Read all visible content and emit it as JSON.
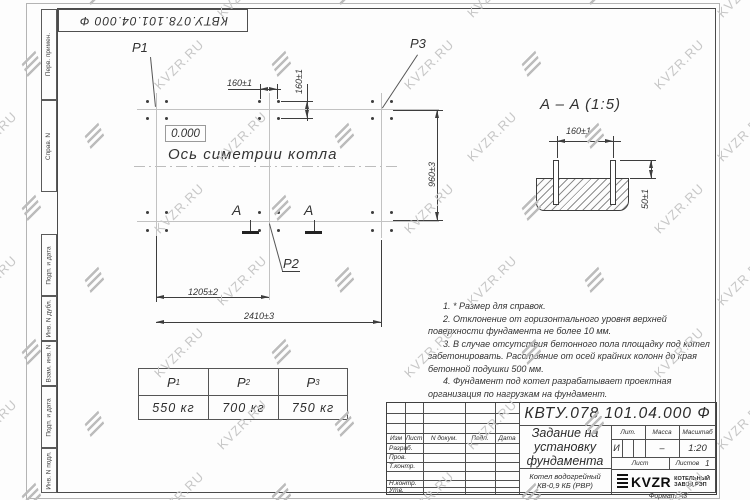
{
  "watermark": {
    "text": "KVZR.RU"
  },
  "corner_stamp": {
    "designation": "КВТУ.078.101.04.000 Ф"
  },
  "margin_columns": {
    "labels": [
      "Перв. примен.",
      "Справ. N",
      "Подп. и дата",
      "Инв. N дубл.",
      "Взам. инв. N",
      "Подп. и дата",
      "Инв. N подл."
    ]
  },
  "plan_view": {
    "load_labels": {
      "p1": "P1",
      "p2": "P2",
      "p3": "P3"
    },
    "elevation_mark": "0.000",
    "symmetry_axis_label": "Ось симетрии котла",
    "section_letter_left": "A",
    "section_letter_right": "A",
    "dimensions": {
      "bolt_spacing_horizontal": "160±1",
      "bolt_spacing_vertical": "160±1",
      "foundation_width": "960±3",
      "axis_to_center": "1205±2",
      "overall_length": "2410±3"
    }
  },
  "section_view": {
    "title": "A – A (1:5)",
    "dimensions": {
      "bolt_spacing": "160±1",
      "bolt_protrusion": "50±1"
    }
  },
  "notes": [
    "1. * Размер для справок.",
    "2. Отклонение от горизонтального уровня верхней поверхности фундамента не более 10 мм.",
    "3. В случае отсутствия бетонного пола площадку под котел забетонировать. Расстояние от осей крайних колонн до края бетонной подушки 500 мм.",
    "4. Фундамент под котел разрабатывает проектная организация по нагрузкам на фундамент."
  ],
  "load_table": {
    "headers": [
      {
        "symbol": "P",
        "index": "1"
      },
      {
        "symbol": "P",
        "index": "2"
      },
      {
        "symbol": "P",
        "index": "3"
      }
    ],
    "values": [
      "550 кг",
      "700 кг",
      "750 кг"
    ]
  },
  "title_block": {
    "designation": "КВТУ.078.101.04.000 Ф",
    "title_lines": [
      "Задание на",
      "установку",
      "фундамента"
    ],
    "product_lines": [
      "Котел водогрейный",
      "КВ-0,9 КБ (РВР)"
    ],
    "revision_headers": [
      "Изм",
      "Лист",
      "N докум.",
      "Подп.",
      "Дата"
    ],
    "signature_labels": [
      "Разраб.",
      "Пров.",
      "Т.контр.",
      "Н.контр.",
      "Утв."
    ],
    "lit_label": "Лит.",
    "mass_label": "Масса",
    "scale_label": "Масштаб",
    "lit_value": "И",
    "mass_value": "–",
    "scale_value": "1:20",
    "sheet_label": "Лист",
    "sheets_label": "Листов",
    "sheets_value": "1",
    "company": {
      "logo": "KVZR",
      "name_lines": [
        "КОТЕЛЬНЫЙ",
        "ЗАВОД РЭП"
      ]
    },
    "format_label": "Формат А3"
  }
}
